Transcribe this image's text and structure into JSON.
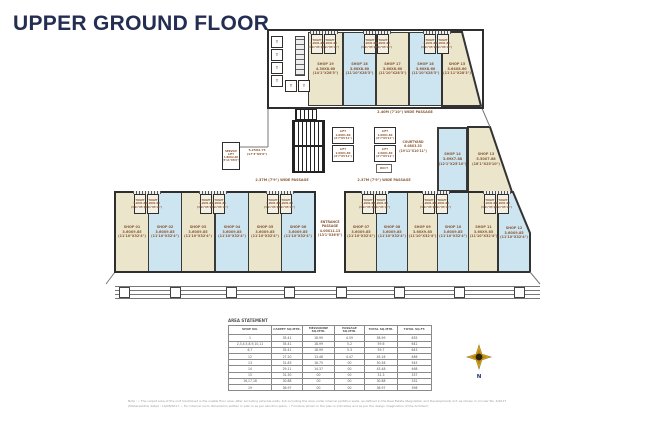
{
  "title": "UPPER GROUND FLOOR",
  "colors": {
    "shop_cream": "#eae5cb",
    "shop_blue": "#cde4f1",
    "wall": "#333333",
    "label_brown": "#8a5a36",
    "title_navy": "#242d52",
    "compass_gold": "#d9a520"
  },
  "plan": {
    "passage_top": "2.40M (7'10\") WIDE PASSAGE",
    "passage_left": "2.37M (7'9\") WIDE PASSAGE",
    "passage_right": "2.37M (7'9\") WIDE PASSAGE",
    "entrance_passage": [
      "ENTRANCE",
      "PASSAGE",
      "4.00X11.13",
      "(13'1\"X36'6\")"
    ],
    "courtyard": [
      "COURTYARD",
      "6.08X3.33",
      "(19'11\"X10'11\")"
    ],
    "service_lift": [
      "SERVICE",
      "LIFT",
      "1.80X2.60",
      "(5'11\"X8'6\")"
    ],
    "stair_dim": [
      "5.25X2.75",
      "(17'3\"X9'0\")"
    ],
    "lift": [
      "LIFT",
      "2.00X1.80",
      "(6'7\"X5'11\")"
    ],
    "duct_label": "DUCT",
    "toilet": [
      "TOILET",
      "1.20X1.80",
      "(3'11\"X5'11\")"
    ],
    "t_label": "T",
    "north_label": "N",
    "shops_top": [
      {
        "no": "SHOP 19",
        "m": "4.30X8.60",
        "ft": "(14'1\"X28'3\")"
      },
      {
        "no": "SHOP 18",
        "m": "3.60X8.60",
        "ft": "(11'10\"X28'3\")"
      },
      {
        "no": "SHOP 17",
        "m": "3.60X8.60",
        "ft": "(11'10\"X28'3\")"
      },
      {
        "no": "SHOP 16",
        "m": "3.60X8.60",
        "ft": "(11'10\"X28'3\")"
      },
      {
        "no": "SHOP 15",
        "m": "3.64X8.60",
        "ft": "(11'11\"X28'3\")"
      }
    ],
    "shops_mid": [
      {
        "no": "SHOP 14",
        "m": "3.69X7.88",
        "ft": "(12'1\"X25'10\")"
      },
      {
        "no": "SHOP 13",
        "m": "5.50X7.88",
        "ft": "(18'1\"X25'10\")"
      }
    ],
    "shops_bottom_left": [
      {
        "no": "SHOP 01",
        "m": "3.60X9.85",
        "ft": "(11'10\"X32'4\")"
      },
      {
        "no": "SHOP 02",
        "m": "3.60X9.85",
        "ft": "(11'10\"X32'4\")"
      },
      {
        "no": "SHOP 03",
        "m": "3.60X9.85",
        "ft": "(11'10\"X32'4\")"
      },
      {
        "no": "SHOP 04",
        "m": "3.60X9.85",
        "ft": "(11'10\"X32'4\")"
      },
      {
        "no": "SHOP 05",
        "m": "3.60X9.85",
        "ft": "(11'10\"X32'4\")"
      },
      {
        "no": "SHOP 06",
        "m": "3.60X9.85",
        "ft": "(11'10\"X32'4\")"
      }
    ],
    "shops_bottom_right": [
      {
        "no": "SHOP 07",
        "m": "3.60X9.85",
        "ft": "(11'10\"X32'4\")"
      },
      {
        "no": "SHOP 08",
        "m": "3.60X9.85",
        "ft": "(11'10\"X32'4\")"
      },
      {
        "no": "SHOP 09",
        "m": "3.60X9.85",
        "ft": "(11'10\"X32'4\")"
      },
      {
        "no": "SHOP 10",
        "m": "3.60X9.85",
        "ft": "(11'10\"X32'4\")"
      },
      {
        "no": "SHOP 11",
        "m": "3.60X9.85",
        "ft": "(11'10\"X32'4\")"
      },
      {
        "no": "SHOP 12",
        "m": "3.60X9.85",
        "ft": "(11'10\"X32'4\")"
      }
    ]
  },
  "table": {
    "title": "AREA STATEMENT",
    "headers": [
      "SHOP NO.",
      "CARPET SQ.MTR.",
      "MEZZANINE SQ.MTR.",
      "PASSAGE SQ.MTR.",
      "TOTAL SQ.MTR.",
      "TOTAL SQ.FT."
    ],
    "rows": [
      [
        "1",
        "35.41",
        "18.99",
        "4.59",
        "58.99",
        "635"
      ],
      [
        "2,3,4,5,8,9,10,11",
        "35.41",
        "18.99",
        "5.2",
        "59.6",
        "642"
      ],
      [
        "6,7",
        "35.41",
        "18.99",
        "5.3",
        "59.7",
        "643"
      ],
      [
        "12",
        "27.20",
        "13.46",
        "4.47",
        "45.16",
        "486"
      ],
      [
        "13",
        "31.83",
        "18.75",
        "00",
        "50.58",
        "545"
      ],
      [
        "14",
        "29.11",
        "14.37",
        "00",
        "43.48",
        "468"
      ],
      [
        "15",
        "31.30",
        "00",
        "00",
        "31.3",
        "337"
      ],
      [
        "16,17,18",
        "30.88",
        "00",
        "00",
        "30.88",
        "332"
      ],
      [
        "19",
        "36.97",
        "00",
        "00",
        "36.97",
        "398"
      ]
    ]
  },
  "note": "Note : • The carpet area of the unit mentioned is the usable floor area, after excluding external walls, but including the area under internal partition walls, as defined in the Real Estate (Regulation and Development) Act, as shown in circular No. 4/2017 (Maharashtra) dated : 14/08/2017.  • For internal room dimensions written in plan is as per sanction plans.  • Furniture shown in the plan is indicative and as per the design imagination of the Architect."
}
